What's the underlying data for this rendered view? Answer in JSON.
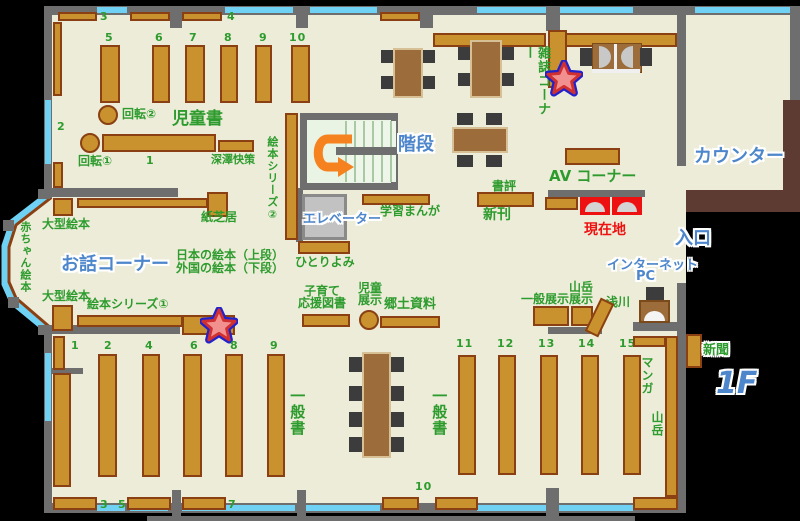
{
  "map": {
    "floor_badge": "1F",
    "areas": {
      "jidosho": "児童書",
      "ohanashi": "お話コーナー",
      "kaidan": "階段",
      "counter": "カウンター",
      "iriguchi": "入口",
      "zasshi_corner": "雑誌コーナー",
      "av_corner": "AV コーナー",
      "genzaichi": "現在地",
      "internet_line1": "インターネット",
      "internet_line2": "PC",
      "ippansho_left": "一般書",
      "ippansho_right": "一般書"
    },
    "labels": {
      "kaiten1": "回転①",
      "kaiten2": "回転②",
      "fukazawa": "深澤快策",
      "ehon_series2": "絵本シリーズ②",
      "kamishibai": "紙芝居",
      "ogata_ehon_upper": "大型絵本",
      "ogata_ehon_lower": "大型絵本",
      "akachan_ehon": "赤ちゃん絵本",
      "nihon_ehon": "日本の絵本（上段）",
      "gaikoku_ehon": "外国の絵本（下段）",
      "hitoriyomi": "ひとりよみ",
      "ehon_series1": "絵本シリーズ①",
      "gakushu_manga": "学習まんが",
      "elevator": "エレベーター",
      "shohyo": "書評",
      "shinkan": "新刊",
      "asakawa": "浅川",
      "sangaku_tenji_l1": "山岳",
      "sangaku_tenji_l2": "展示",
      "ippan_tenji": "一般展示",
      "kosodate_l1": "子育て",
      "kosodate_l2": "応援図書",
      "jido_tenji_l1": "児童",
      "jido_tenji_l2": "展示",
      "kyodo_shiryo": "郷土資料",
      "manga": "マンガ",
      "sangaku": "山岳",
      "shinbun": "新聞"
    },
    "shelf_numbers": {
      "c1": "1",
      "c2": "2",
      "c3": "3",
      "c4": "4",
      "c5": "5",
      "c6": "6",
      "c7": "7",
      "c8": "8",
      "c9": "9",
      "c10": "10",
      "g1": "1",
      "g2": "2",
      "g3": "3",
      "g4": "4",
      "g5": "5",
      "g6": "6",
      "g7": "7",
      "g8": "8",
      "g9": "9",
      "g10": "10",
      "g11": "11",
      "g12": "12",
      "g13": "13",
      "g14": "14",
      "g15": "15"
    },
    "colors": {
      "floor": "#edecd9",
      "wall": "#6e6e6e",
      "window": "#6fd2f5",
      "shelf": "#c9922f",
      "shelf_border": "#8a4012",
      "accent_green": "#2d9b2d",
      "accent_blue": "#4d86cb",
      "highlight_red": "#ee1111",
      "counter_brown": "#5d3b33",
      "arrow_orange": "#f5821e"
    }
  }
}
